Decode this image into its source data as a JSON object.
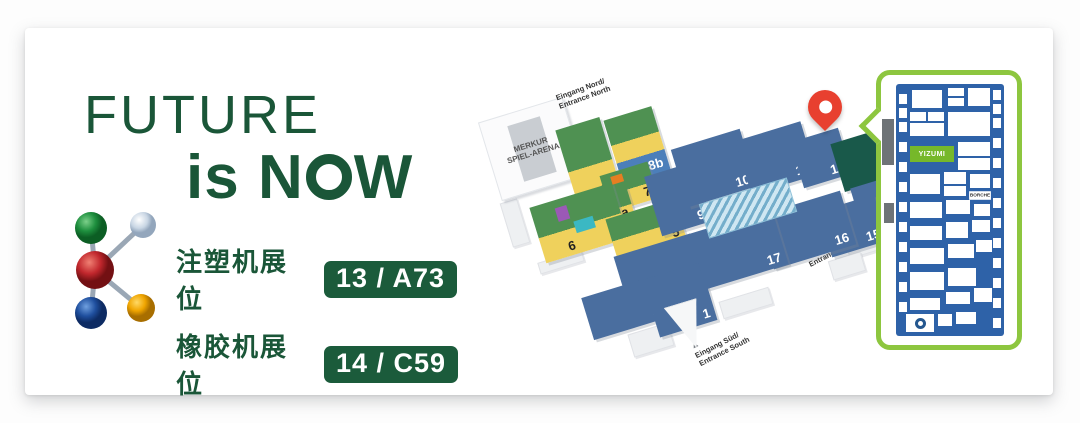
{
  "banner": {
    "headline": {
      "line1": "FUTURE",
      "is": "is",
      "n": "N",
      "o": "O",
      "w": "W"
    },
    "accent_color": "#1A5638"
  },
  "booths": {
    "rows": [
      {
        "label": "注塑机展位",
        "badge": "13 / A73"
      },
      {
        "label": "橡胶机展位",
        "badge": "14 / C59"
      }
    ],
    "badge_color": "#1B5B3B"
  },
  "k_logo": {
    "icon": "k-show-molecule-logo",
    "sphere_colors": {
      "green": "#1E8F3E",
      "silver": "#C9D6E4",
      "red": "#C1272D",
      "blue": "#1F4F9E",
      "yellow": "#F0A500"
    }
  },
  "map": {
    "arena_label": "MERKUR\nSPIEL-ARENA",
    "entrances": {
      "north": "Eingang Nord/\nEntrance North",
      "east": "Eingang Ost/\nEntrance East",
      "south": "Eingang Süd/\nEntrance South"
    },
    "halls": {
      "h1": "1",
      "h3": "3",
      "h4": "4",
      "h5": "5",
      "h6": "6",
      "h7": "7",
      "h7a": "7a",
      "h8a": "8a",
      "h8b": "8b",
      "h9": "9",
      "h10": "10",
      "h11": "11",
      "h12": "12",
      "h13": "13",
      "h14": "14",
      "h15": "15",
      "h16": "16",
      "h17": "17"
    },
    "highlighted_hall": "13",
    "icons": {
      "location_pin": "map-pin",
      "entrance_arrow": "▲"
    },
    "colors": {
      "hall_blue": "#4A6E9F",
      "hall_green": "#4F9152",
      "hall_yellow": "#EFD15C",
      "highlight_green": "#19594A",
      "pin_red": "#E8402F"
    }
  },
  "callout": {
    "border_color": "#8DC63F",
    "plan_blue": "#2E62A8",
    "yizumi_label": "YIZUMI",
    "borche_label": "BORCHE"
  }
}
